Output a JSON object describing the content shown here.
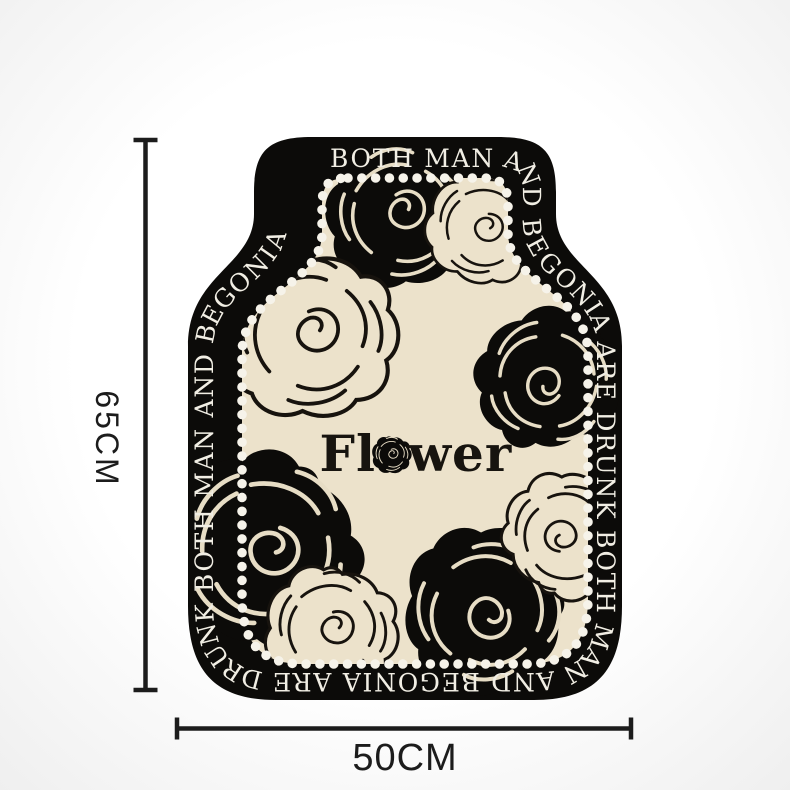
{
  "mat": {
    "border_text": "BOTH MAN AND BEGONIA ARE DRUNK BOTH MAN AND BEGONIA ARE DRUNK BOTH MAN AND BEGONIA",
    "brand": {
      "prefix": "Fl",
      "suffix": "wer",
      "o_replacement_icon": "rose-icon"
    }
  },
  "dimensions": {
    "height": "65CM",
    "width": "50CM"
  },
  "icons": {
    "rose_black": "solid-black-rose",
    "rose_outline": "outlined-rose",
    "pearl_border": "pearl-dot-chain"
  },
  "theme": {
    "mat-black": "#0c0b09",
    "mat-cream": "#ece2cb",
    "pearl": "#f6f3ea",
    "border-text-color": "#f1eee4",
    "brand-color": "#17140f",
    "dimension-color": "#1c1c1c",
    "bg-center": "#ffffff",
    "bg-edge": "#efefef"
  }
}
